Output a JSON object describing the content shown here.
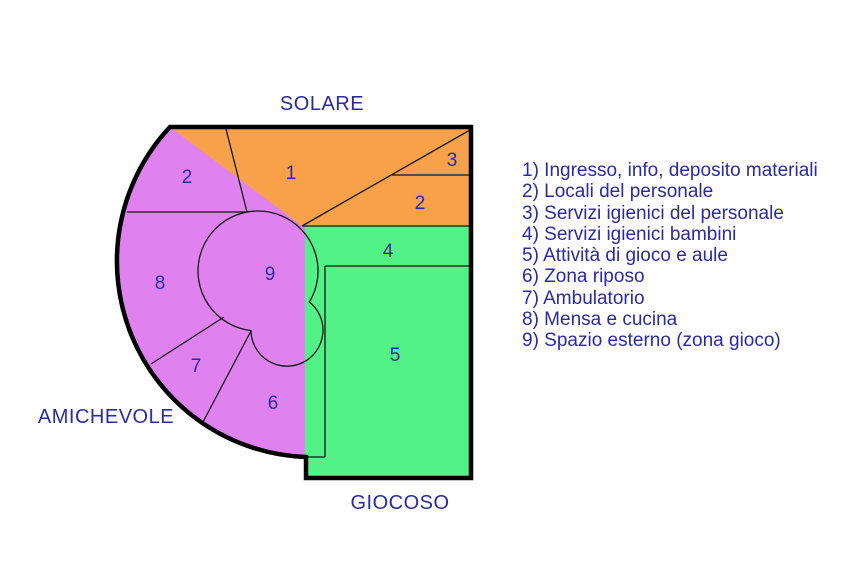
{
  "zone_titles": {
    "top": "SOLARE",
    "left": "AMICHEVOLE",
    "bottom": "GIOCOSO"
  },
  "plan": {
    "numbers": {
      "r1": "1",
      "r2_top": "2",
      "r3": "3",
      "r2_right": "2",
      "r4": "4",
      "r5": "5",
      "r6": "6",
      "r7": "7",
      "r8": "8",
      "r9": "9"
    }
  },
  "legend": {
    "items": [
      {
        "label": "1) Ingresso, info, deposito materiali"
      },
      {
        "label": "2) Locali del personale"
      },
      {
        "label": "3) Servizi igienici del personale"
      },
      {
        "label": "4) Servizi igienici bambini"
      },
      {
        "label": "5) Attività di gioco e aule"
      },
      {
        "label": "6) Zona riposo"
      },
      {
        "label": "7) Ambulatorio"
      },
      {
        "label": "8) Mensa e cucina"
      },
      {
        "label": "9) Spazio esterno (zona gioco)"
      }
    ]
  },
  "colors": {
    "orange": "#F8A14B",
    "violet": "#DF82F0",
    "green": "#53F287",
    "text_blue": "#2A2AA2",
    "line_black": "#141414"
  }
}
